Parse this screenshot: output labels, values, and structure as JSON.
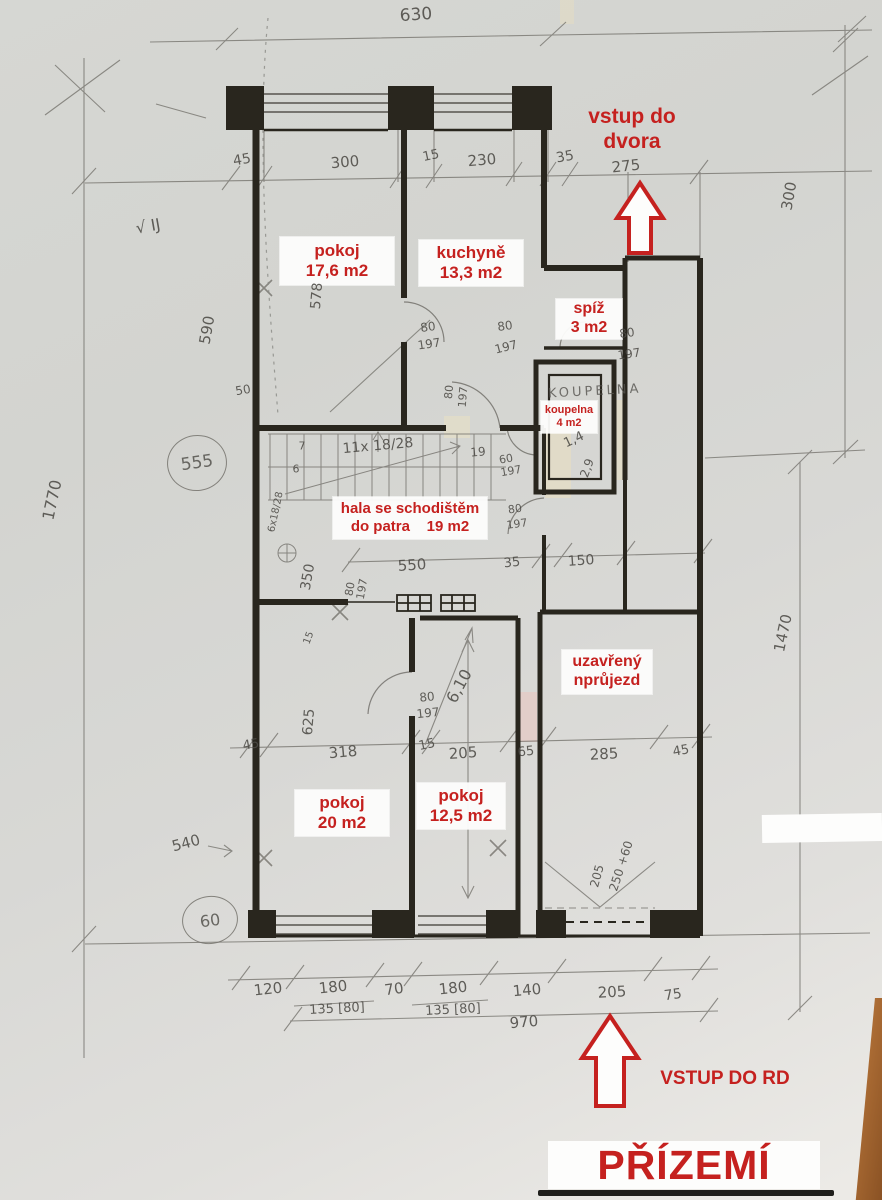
{
  "floor_title": "PŘÍZEMÍ",
  "colors": {
    "red_accent": "#c5211f",
    "paper": "#d6d7d3",
    "pencil": "#5c5a55",
    "wall": "#29261e",
    "wood_edge": "#a96a33"
  },
  "notes": {
    "dvora_line1": "vstup do",
    "dvora_line2": "dvora",
    "vstup_rd": "VSTUP DO RD",
    "prizemi": "PŘÍZEMÍ",
    "koupelna_hand": "KOUPELNA"
  },
  "rooms": [
    {
      "id": "pokoj-176",
      "lines": [
        "pokoj",
        "17,6 m2"
      ],
      "cx": 337,
      "cy": 261,
      "w": 114,
      "h": 48,
      "fs": 17
    },
    {
      "id": "kuchyne",
      "lines": [
        "kuchyně",
        "13,3 m2"
      ],
      "cx": 471,
      "cy": 263,
      "w": 104,
      "h": 46,
      "fs": 17
    },
    {
      "id": "spiz",
      "lines": [
        "spíž",
        "3 m2"
      ],
      "cx": 589,
      "cy": 319,
      "w": 66,
      "h": 40,
      "fs": 16
    },
    {
      "id": "koupelna",
      "lines": [
        "koupelna",
        "4 m2"
      ],
      "cx": 569,
      "cy": 417,
      "w": 56,
      "h": 32,
      "fs": 11
    },
    {
      "id": "hala",
      "lines": [
        "hala se schodištěm",
        "do patra    19 m2"
      ],
      "cx": 410,
      "cy": 518,
      "w": 154,
      "h": 42,
      "fs": 15
    },
    {
      "id": "prujezd",
      "lines": [
        "uzavřený",
        "nprůjezd"
      ],
      "cx": 607,
      "cy": 672,
      "w": 90,
      "h": 44,
      "fs": 16
    },
    {
      "id": "pokoj-20",
      "lines": [
        "pokoj",
        "20 m2"
      ],
      "cx": 342,
      "cy": 813,
      "w": 94,
      "h": 46,
      "fs": 17
    },
    {
      "id": "pokoj-125",
      "lines": [
        "pokoj",
        "12,5 m2"
      ],
      "cx": 461,
      "cy": 806,
      "w": 88,
      "h": 46,
      "fs": 17
    }
  ],
  "circled": [
    {
      "t": "555",
      "x": 196,
      "y": 462,
      "rx": 29,
      "ry": 27,
      "fs": 17
    },
    {
      "t": "60",
      "x": 209,
      "y": 919,
      "rx": 27,
      "ry": 23,
      "fs": 16
    }
  ],
  "dims": [
    {
      "t": "630",
      "x": 416,
      "y": 15,
      "r": -4,
      "s": 17
    },
    {
      "t": "45",
      "x": 242,
      "y": 160,
      "r": -10,
      "s": 14
    },
    {
      "t": "300",
      "x": 345,
      "y": 162,
      "r": -5,
      "s": 15
    },
    {
      "t": "15",
      "x": 431,
      "y": 156,
      "r": -12,
      "s": 13
    },
    {
      "t": "230",
      "x": 482,
      "y": 160,
      "r": -5,
      "s": 15
    },
    {
      "t": "35",
      "x": 565,
      "y": 157,
      "r": -10,
      "s": 14
    },
    {
      "t": "275",
      "x": 626,
      "y": 166,
      "r": -6,
      "s": 15
    },
    {
      "t": "300",
      "x": 789,
      "y": 196,
      "r": -80,
      "s": 15
    },
    {
      "t": "√ IJ",
      "x": 148,
      "y": 226,
      "r": -10,
      "s": 16
    },
    {
      "t": "590",
      "x": 207,
      "y": 330,
      "r": -80,
      "s": 15
    },
    {
      "t": "578",
      "x": 317,
      "y": 296,
      "r": -85,
      "s": 14
    },
    {
      "t": "50",
      "x": 243,
      "y": 390,
      "r": -10,
      "s": 12
    },
    {
      "t": "80",
      "x": 428,
      "y": 327,
      "r": -8,
      "s": 12
    },
    {
      "t": "197",
      "x": 429,
      "y": 344,
      "r": -8,
      "s": 12
    },
    {
      "t": "80",
      "x": 505,
      "y": 326,
      "r": -8,
      "s": 12
    },
    {
      "t": "197",
      "x": 506,
      "y": 347,
      "r": -14,
      "s": 12
    },
    {
      "t": "80",
      "x": 627,
      "y": 333,
      "r": -8,
      "s": 12
    },
    {
      "t": "197",
      "x": 629,
      "y": 354,
      "r": -8,
      "s": 12
    },
    {
      "t": "80",
      "x": 449,
      "y": 392,
      "r": -85,
      "s": 11
    },
    {
      "t": "197",
      "x": 463,
      "y": 397,
      "r": -85,
      "s": 11
    },
    {
      "t": "11x 18/28",
      "x": 378,
      "y": 446,
      "r": -5,
      "s": 14
    },
    {
      "t": "7",
      "x": 302,
      "y": 446,
      "r": 0,
      "s": 11
    },
    {
      "t": "6",
      "x": 296,
      "y": 469,
      "r": 0,
      "s": 11
    },
    {
      "t": "19",
      "x": 478,
      "y": 452,
      "r": -5,
      "s": 12
    },
    {
      "t": "60",
      "x": 506,
      "y": 459,
      "r": -10,
      "s": 11
    },
    {
      "t": "197",
      "x": 511,
      "y": 471,
      "r": -10,
      "s": 11
    },
    {
      "t": "6x18/28",
      "x": 276,
      "y": 512,
      "r": -78,
      "s": 10
    },
    {
      "t": "80",
      "x": 515,
      "y": 509,
      "r": -8,
      "s": 11
    },
    {
      "t": "197",
      "x": 517,
      "y": 524,
      "r": -8,
      "s": 11
    },
    {
      "t": "1,4",
      "x": 574,
      "y": 440,
      "r": -25,
      "s": 13
    },
    {
      "t": "2,9",
      "x": 587,
      "y": 468,
      "r": -70,
      "s": 12
    },
    {
      "t": "350",
      "x": 308,
      "y": 577,
      "r": -80,
      "s": 14
    },
    {
      "t": "550",
      "x": 412,
      "y": 565,
      "r": -4,
      "s": 15
    },
    {
      "t": "35",
      "x": 512,
      "y": 563,
      "r": -6,
      "s": 13
    },
    {
      "t": "150",
      "x": 581,
      "y": 561,
      "r": -4,
      "s": 14
    },
    {
      "t": "80",
      "x": 350,
      "y": 589,
      "r": -80,
      "s": 11
    },
    {
      "t": "197",
      "x": 362,
      "y": 589,
      "r": -80,
      "s": 11
    },
    {
      "t": "15",
      "x": 309,
      "y": 638,
      "r": -70,
      "s": 10
    },
    {
      "t": "625",
      "x": 309,
      "y": 722,
      "r": -85,
      "s": 14
    },
    {
      "t": "6,10",
      "x": 459,
      "y": 686,
      "r": -62,
      "s": 16
    },
    {
      "t": "80",
      "x": 427,
      "y": 697,
      "r": -6,
      "s": 12
    },
    {
      "t": "197",
      "x": 428,
      "y": 713,
      "r": -6,
      "s": 12
    },
    {
      "t": "45",
      "x": 251,
      "y": 745,
      "r": -10,
      "s": 13
    },
    {
      "t": "318",
      "x": 343,
      "y": 752,
      "r": -5,
      "s": 15
    },
    {
      "t": "15",
      "x": 427,
      "y": 745,
      "r": -12,
      "s": 13
    },
    {
      "t": "205",
      "x": 463,
      "y": 753,
      "r": -4,
      "s": 15
    },
    {
      "t": "65",
      "x": 526,
      "y": 752,
      "r": -6,
      "s": 13
    },
    {
      "t": "285",
      "x": 604,
      "y": 754,
      "r": -3,
      "s": 15
    },
    {
      "t": "45",
      "x": 681,
      "y": 751,
      "r": -10,
      "s": 13
    },
    {
      "t": "540",
      "x": 186,
      "y": 843,
      "r": -15,
      "s": 15
    },
    {
      "t": "205",
      "x": 597,
      "y": 876,
      "r": -75,
      "s": 12
    },
    {
      "t": "250 +60",
      "x": 621,
      "y": 866,
      "r": -72,
      "s": 12
    },
    {
      "t": "1770",
      "x": 52,
      "y": 500,
      "r": -78,
      "s": 16
    },
    {
      "t": "1470",
      "x": 783,
      "y": 633,
      "r": -78,
      "s": 15
    },
    {
      "t": "120",
      "x": 268,
      "y": 989,
      "r": -6,
      "s": 15
    },
    {
      "t": "180",
      "x": 333,
      "y": 987,
      "r": -6,
      "s": 15
    },
    {
      "t": "70",
      "x": 394,
      "y": 989,
      "r": -8,
      "s": 15
    },
    {
      "t": "180",
      "x": 453,
      "y": 988,
      "r": -6,
      "s": 15
    },
    {
      "t": "140",
      "x": 527,
      "y": 990,
      "r": -5,
      "s": 15
    },
    {
      "t": "205",
      "x": 612,
      "y": 992,
      "r": -3,
      "s": 15
    },
    {
      "t": "75",
      "x": 673,
      "y": 995,
      "r": -8,
      "s": 14
    },
    {
      "t": "135 [80]",
      "x": 337,
      "y": 1009,
      "r": -3,
      "s": 13
    },
    {
      "t": "135 [80]",
      "x": 453,
      "y": 1010,
      "r": -3,
      "s": 13
    },
    {
      "t": "970",
      "x": 524,
      "y": 1022,
      "r": -5,
      "s": 15
    }
  ]
}
